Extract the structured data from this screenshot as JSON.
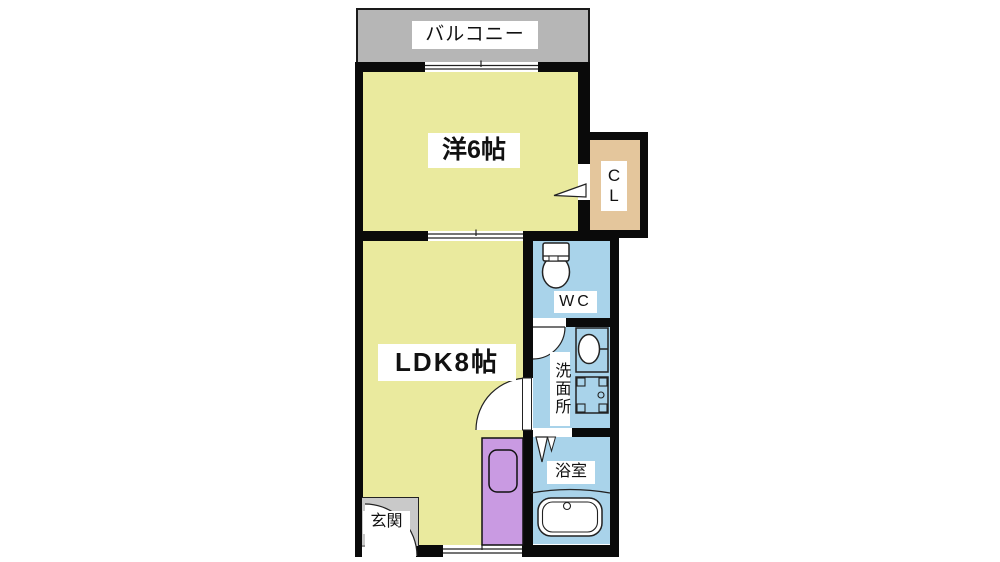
{
  "plan": {
    "title": "1LDK apartment floor plan",
    "balcony": {
      "label": "バルコニー"
    },
    "western_room": {
      "label": "洋6帖"
    },
    "closet": {
      "label_top": "C",
      "label_bottom": "L"
    },
    "ldk": {
      "label": "LDK8帖"
    },
    "wc": {
      "label": "WC"
    },
    "washroom": {
      "label": "洗面所"
    },
    "bathroom": {
      "label": "浴室"
    },
    "entrance": {
      "label": "玄関"
    },
    "icons": {
      "toilet": "toilet-icon",
      "sink": "sink-icon",
      "washing_machine": "washing-machine-icon",
      "bathtub": "bathtub-icon",
      "kitchen_sink": "kitchen-sink-icon",
      "door_swing": "door-swing-arc",
      "folding_door": "folding-door-icon",
      "sliding_window": "sliding-window-icon"
    },
    "colors": {
      "room_yellow": "#eaea9e",
      "wet_blue": "#a9d3ea",
      "closet_tan": "#e4c69c",
      "kitchen_purple": "#c99ae2",
      "balcony_gray": "#b6b6b6",
      "entrance_gray": "#c9c9c9",
      "wall_black": "#0a0a0a"
    }
  }
}
